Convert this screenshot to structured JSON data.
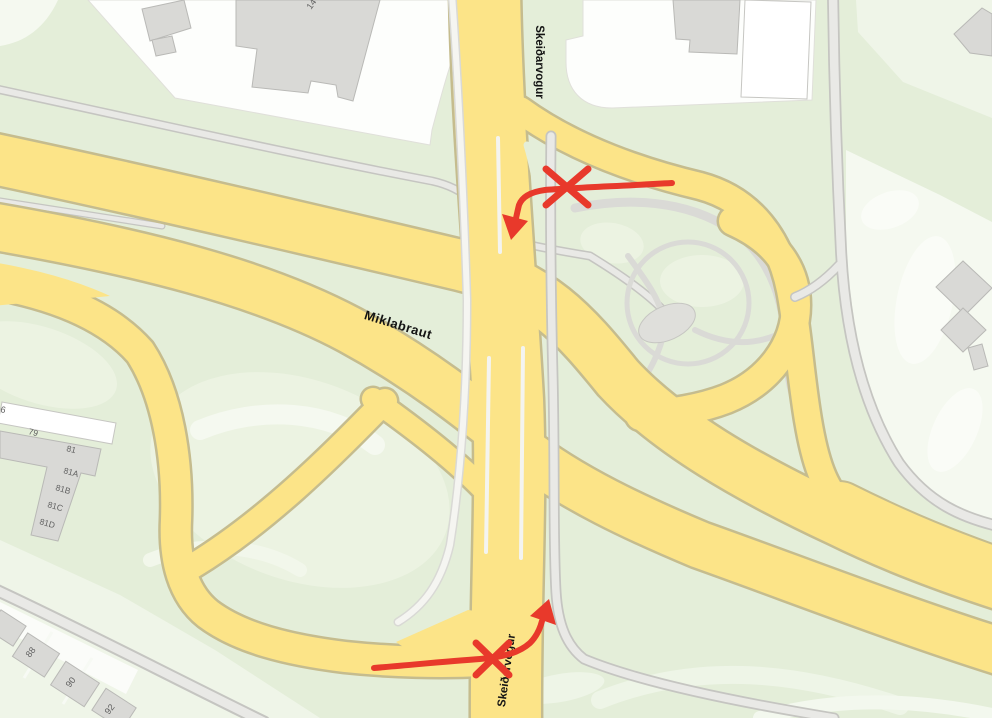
{
  "colors": {
    "base_green": "#e4eed9",
    "pale_green": "#eff5e8",
    "paler_green": "#f5f9f0",
    "blob_white": "#fafcf7",
    "lot_white": "#fdfefc",
    "road_yellow": "#fce488",
    "road_yellow_casing": "#c5bc8e",
    "road_gray_fill": "#e9e9e6",
    "road_gray_casing": "#c5c5c1",
    "path_gray": "#dadad6",
    "building_gray": "#d9d9d6",
    "building_stroke": "#b9b9b6",
    "building_white": "#ffffff",
    "label_dark": "#141414",
    "label_gray": "#5f5f5f",
    "annotation_red": "#e8392b"
  },
  "road_labels": {
    "miklabraut": "Miklabraut",
    "skeidarvogur_north": "Skeiðarvogur",
    "skeidarvogur_south": "Skeiðarvogur"
  },
  "house_numbers": {
    "n6": "6",
    "n14": "14",
    "n79": "79",
    "n81": "81",
    "n81a": "81A",
    "n81b": "81B",
    "n81c": "81C",
    "n81d": "81D",
    "n88": "88",
    "n90": "90",
    "n92": "92"
  },
  "annotations": {
    "north_blocked_turn": "arrow-with-x-mark",
    "south_blocked_turn": "arrow-with-x-mark"
  }
}
